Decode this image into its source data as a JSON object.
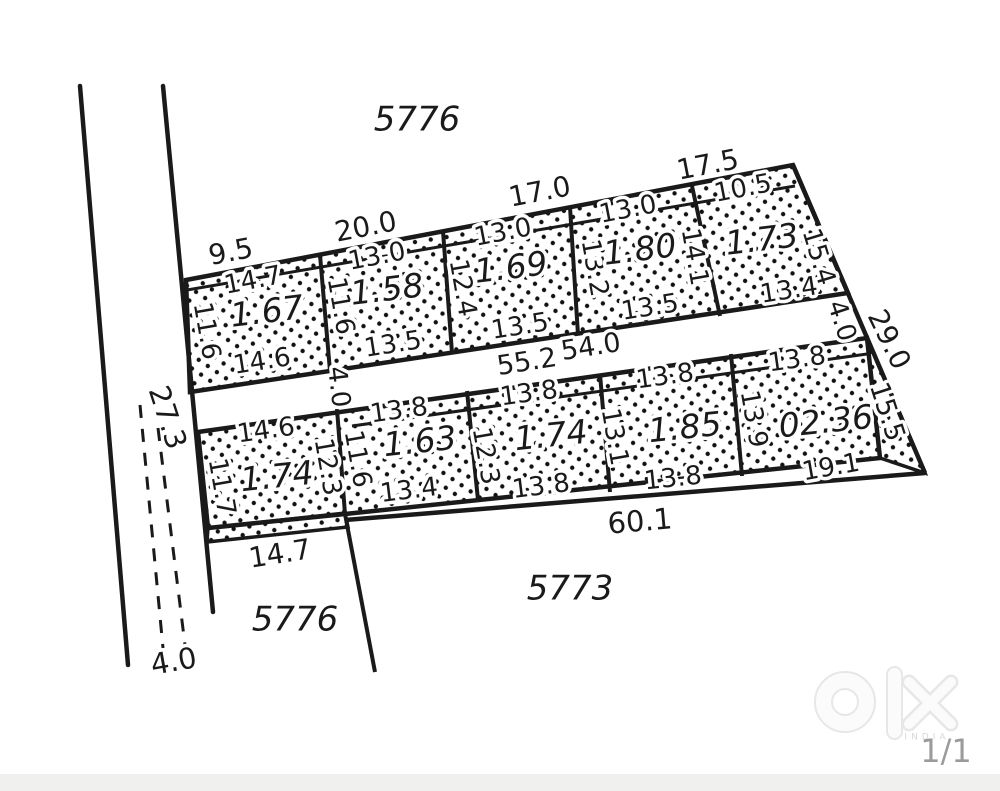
{
  "parcels": {
    "top": "5776",
    "bottom_left": "5776",
    "bottom_center": "5773"
  },
  "left_road": {
    "width_label": "27.3",
    "end_width_label": "4.0"
  },
  "service_road": {
    "left_width": "4.0",
    "length_a": "55.2",
    "length_b": "54.0",
    "right_width": "4.0"
  },
  "boundary": {
    "top_offsets": [
      "9.5",
      "20.0",
      "17.0",
      "17.5"
    ],
    "right_upper": "29.0",
    "right_lower": "15.5",
    "bottom": "60.1"
  },
  "top_row": [
    {
      "area": "1.67",
      "top": "14.7",
      "left": "11.6",
      "bottom": "14.6"
    },
    {
      "area": "1.58",
      "top": "13.0",
      "left": "11.6",
      "bottom": "13.5"
    },
    {
      "area": "1.69",
      "top": "13.0",
      "left": "12.4",
      "bottom": "13.5"
    },
    {
      "area": "1.80",
      "top": "13.0",
      "left": "13.2",
      "right": "14.1",
      "bottom": "13.5"
    },
    {
      "area": "1.73",
      "top": "10.5",
      "right": "15.4",
      "bottom": "13.4"
    }
  ],
  "bottom_row": [
    {
      "area": "1.74",
      "top": "14.6",
      "left": "11.7",
      "right": "12.3",
      "bottom": "14.7"
    },
    {
      "area": "1.63",
      "top": "13.8",
      "left": "11.6",
      "bottom": "13.4"
    },
    {
      "area": "1.74",
      "top": "13.8",
      "left": "12.3",
      "bottom": "13.8"
    },
    {
      "area": "1.85",
      "top": "13.8",
      "left": "13.1",
      "bottom": "13.8"
    },
    {
      "area": "02.36",
      "top": "13.8",
      "left": "13.9",
      "bottom": "19.1"
    }
  ],
  "watermark": {
    "country": "INDIA",
    "page": "1/1"
  },
  "colors": {
    "line": "#1a1a1a",
    "watermark_outline": "#e7e7e7",
    "footer_bar": "#f0f0ef",
    "page_indicator": "#9b9b9b"
  }
}
